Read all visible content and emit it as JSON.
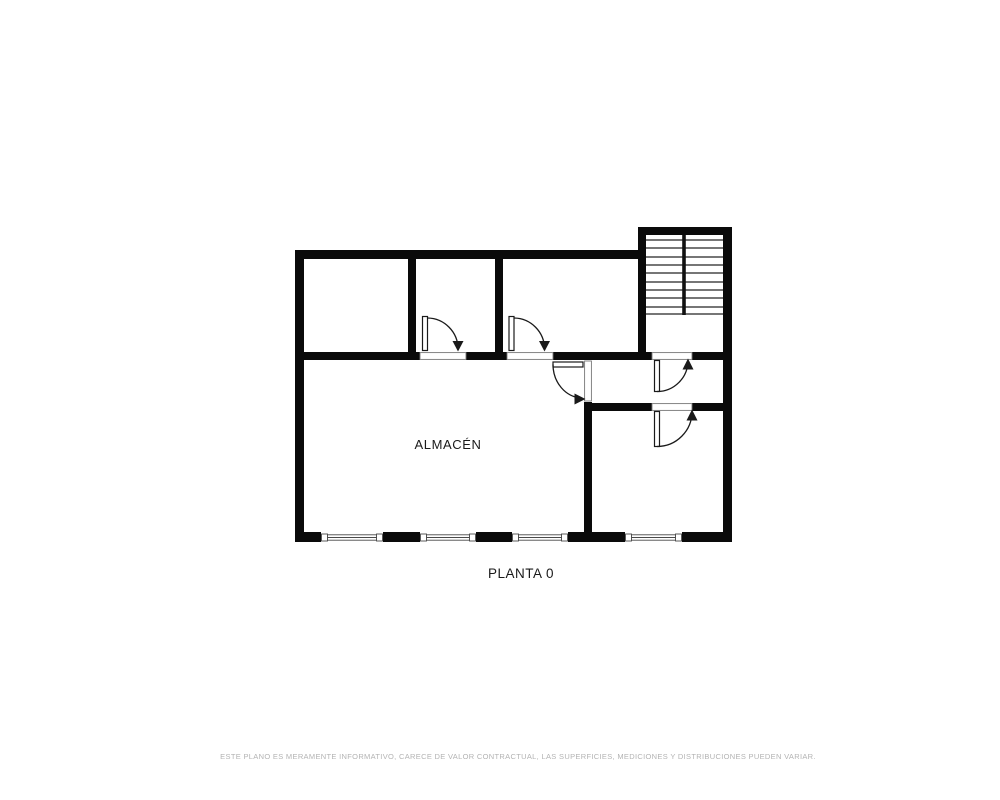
{
  "plan": {
    "floor_title": "PLANTA 0",
    "rooms": [
      {
        "label": "ALMACÉN"
      }
    ],
    "disclaimer": "ESTE PLANO ES MERAMENTE INFORMATIVO, CARECE DE VALOR CONTRACTUAL, LAS SUPERFICIES, MEDICIONES Y DISTRIBUCIONES PUEDEN VARIAR.",
    "elements": {
      "door_count": 5,
      "window_count": 4,
      "staircase": true,
      "stair_tread_lines": 10
    },
    "colors": {
      "background": "#ffffff",
      "wall": "#0a0a0a",
      "label_text": "#1a1a1a",
      "disclaimer_text": "#b3b3b3",
      "window_frame": "#4a4a4a"
    }
  }
}
